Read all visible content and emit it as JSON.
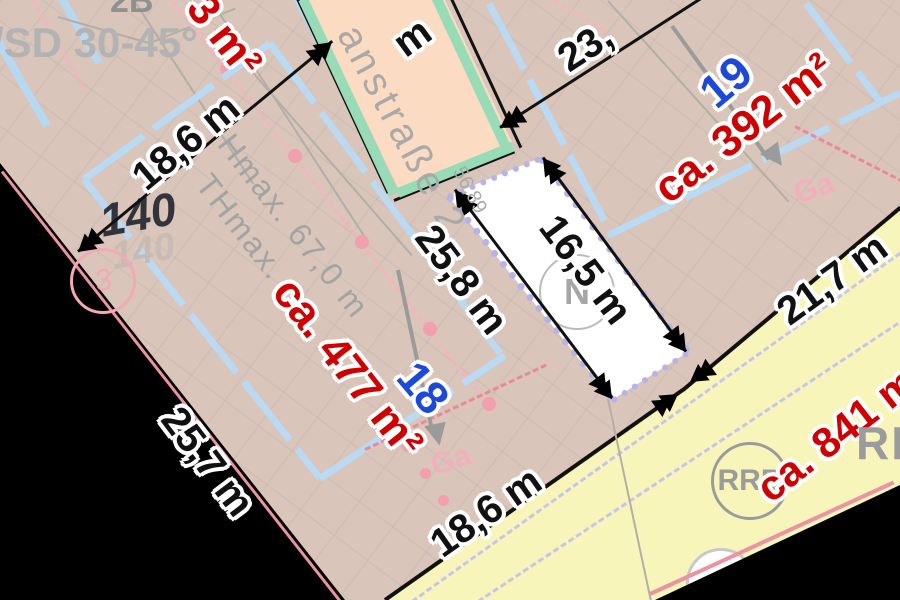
{
  "map_type": "development-plan",
  "street": {
    "name_visible": "anstraße 2",
    "station": "56,89"
  },
  "parcel18": {
    "number": "18",
    "area": "ca. 477 m²",
    "hmax": "Hmax. 67,0 m",
    "thmax": "THmax.",
    "plot_number": "140",
    "plot_number_ghost": "140",
    "boundary_point": "3",
    "garage": "Ga"
  },
  "parcel19": {
    "number": "19",
    "area": "ca. 392 m²",
    "garage": "Ga"
  },
  "basin": {
    "circle_label": "RRB",
    "big_label_fragment": "RRB",
    "area": "ca. 841 m"
  },
  "north_indicator": "N",
  "neighbor": {
    "roof_text": "/SD 30-45°",
    "area_fragment": "3 m²",
    "label_fragment": "2B"
  },
  "measurements": {
    "west": "18,6 m",
    "north": "23,",
    "strip_left": "25,8 m",
    "strip_right": "16,5 m",
    "east": "21,7 m",
    "south": "18,6 m",
    "edge": "25,7 m",
    "top_fragment": "m"
  },
  "colors": {
    "parcel_fill": "#d9c5b9",
    "street_fill": "#fbdcc3",
    "street_edge_green": "#97dcb6",
    "envelope_blue": "#bad9f3",
    "basin_yellow": "#f8f5bb",
    "boundary_pink": "#f2a0ae",
    "label_red": "#cf0000",
    "label_blue": "#1c49d8",
    "label_gray": "#a5a5a5"
  }
}
